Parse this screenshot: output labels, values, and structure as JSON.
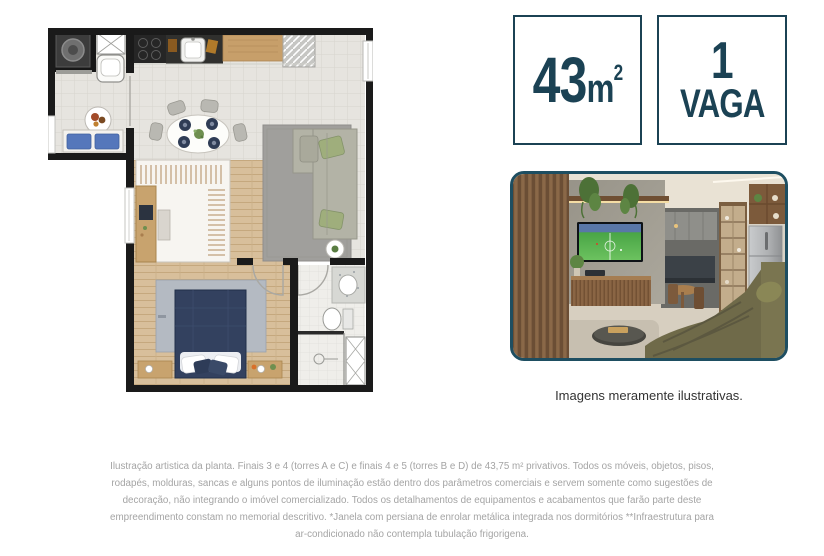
{
  "badges": {
    "border_color": "#1b4254",
    "text_color": "#1b4254",
    "area": {
      "value": "43",
      "unit": "m",
      "sup": "2"
    },
    "parking": {
      "value": "1",
      "label": "VAGA"
    }
  },
  "photo": {
    "caption": "Imagens meramente ilustrativas.",
    "border_color": "#1e4e61"
  },
  "disclaimer": {
    "color": "#a4a4a4",
    "lines": [
      "Ilustração artistica da planta. Finais 3 e 4 (torres A e C) e finais 4 e 5 (torres B e D) de 43,75 m² privativos. Todos os móveis, objetos, pisos,",
      "rodapés, molduras, sancas e alguns pontos de iluminação estão dentro dos parâmetros comerciais e servem somente como sugestões de",
      "decoração, não integrando o imóvel comercializado. Todos os detalhamentos de equipamentos e acabamentos que farão parte deste",
      "empreendimento constam no memorial descritivo. *Janela com persiana de enrolar metálica integrada nos dormitórios **Infraestrutura para",
      "ar-condicionado não contempla tubulação frigorigena."
    ]
  }
}
